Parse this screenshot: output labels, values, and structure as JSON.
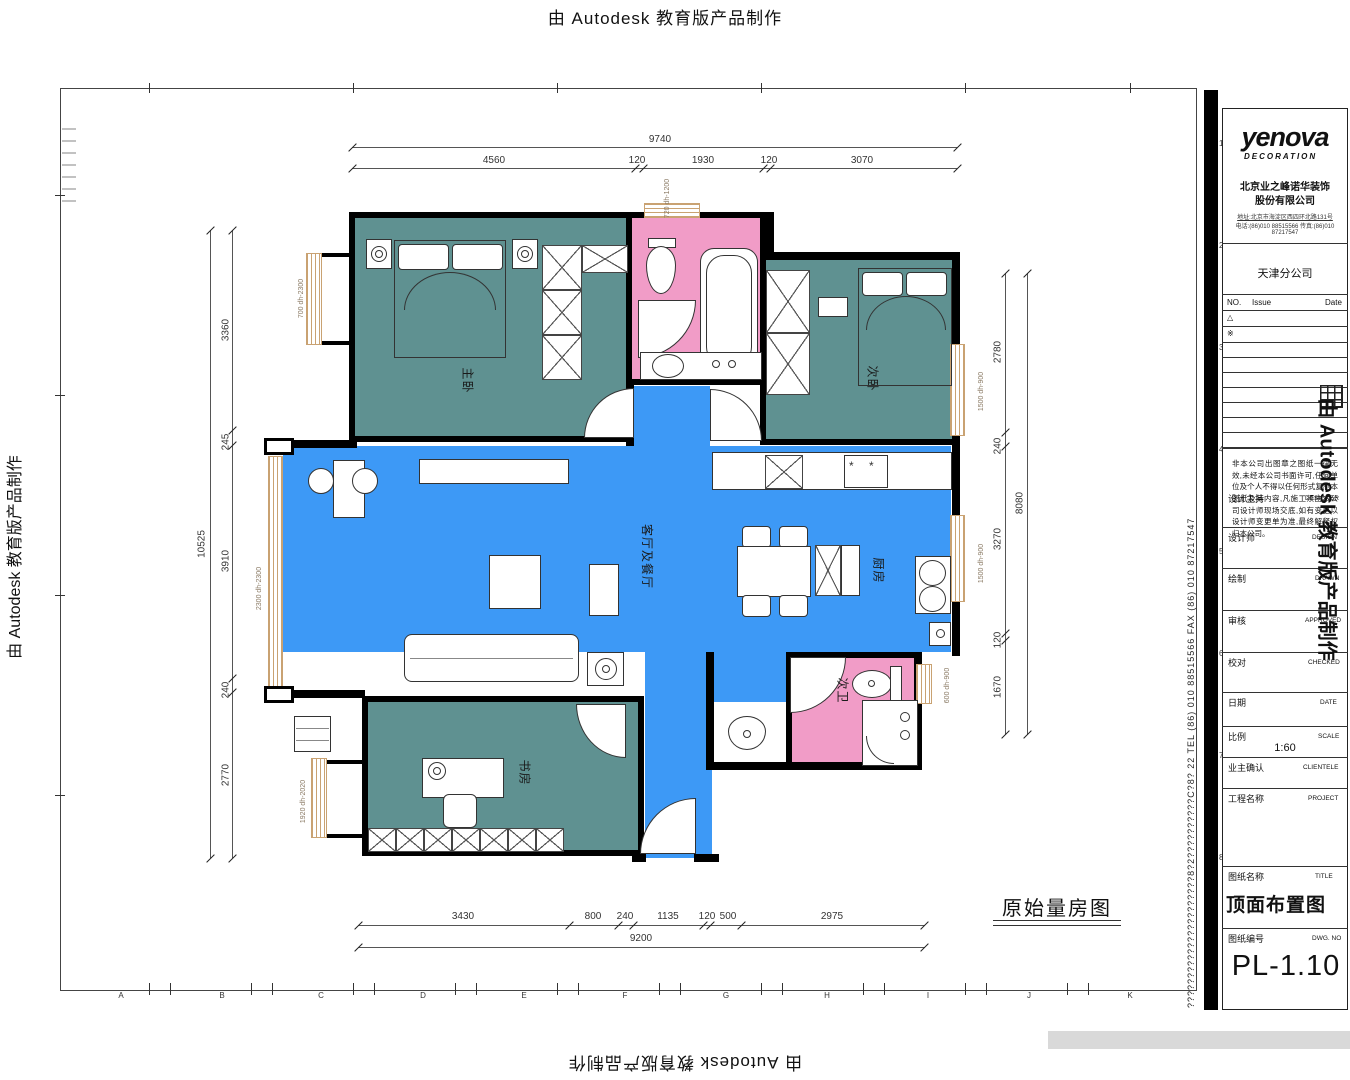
{
  "watermark": {
    "text": "由 Autodesk 教育版产品制作"
  },
  "plan": {
    "caption": "原始量房图",
    "rooms": [
      "主卧",
      "次卧",
      "客厅及餐厅",
      "厨房",
      "次卫",
      "书房"
    ],
    "window_tags": [
      "700 dh-2300",
      "2300 dh-2300",
      "1920 dh-2020",
      "720 dh-1200",
      "1500 dh-900",
      "1500 dh-900",
      "600 dh-900"
    ]
  },
  "dimensions": {
    "top": {
      "overall": "9740",
      "segments": [
        "4560",
        "120",
        "1930",
        "120",
        "3070"
      ]
    },
    "bottom": {
      "overall": "9200",
      "segments": [
        "3430",
        "800",
        "240",
        "1135",
        "120",
        "500",
        "2975"
      ]
    },
    "left": {
      "overall": "10525",
      "segments": [
        "3360",
        "245",
        "3910",
        "240",
        "2770"
      ]
    },
    "right": {
      "overall": "8080",
      "segments": [
        "2780",
        "240",
        "3270",
        "120",
        "1670"
      ]
    }
  },
  "sheet": {
    "zone_letters": [
      "A",
      "B",
      "C",
      "D",
      "E",
      "F",
      "G",
      "H",
      "I",
      "J",
      "K"
    ],
    "zone_numbers": [
      "1",
      "2",
      "3",
      "4",
      "5",
      "6",
      "7",
      "8"
    ],
    "side_contact": "??????????????????????8?2??????????C?8?  22  TEL (86) 010 88515566  FAX (86) 010 87217547"
  },
  "title_block": {
    "logo_main": "yenova",
    "logo_sub": "DECORATION",
    "company_line1": "北京业之峰诺华装饰",
    "company_line2": "股份有限公司",
    "company_info1": "地址:北京市海淀区西四环北路131号",
    "company_info2": "电话:(86)010 88515566 传真:(86)010 87217547",
    "branch": "天津分公司",
    "rev_no": "NO.",
    "rev_issue": "Issue",
    "rev_date": "Date",
    "rev_rows": [
      "△",
      "※"
    ],
    "disclaimer": "非本公司出图章之图纸一律无效,未经本公司书面许可,任何单位及个人不得以任何形式复制本图纸及其内容,凡施工须由本公司设计师现场交底,如有变更以设计师变更单为准,最终解释权归本公司。",
    "fields": [
      {
        "cn": "设计主持",
        "en": "DESIGNER"
      },
      {
        "cn": "设计师",
        "en": "DESIGN"
      },
      {
        "cn": "绘制",
        "en": "DRAWN"
      },
      {
        "cn": "审核",
        "en": "APPROVED"
      },
      {
        "cn": "校对",
        "en": "CHECKED"
      },
      {
        "cn": "日期",
        "en": "DATE"
      },
      {
        "cn": "比例",
        "en": "SCALE"
      },
      {
        "cn": "业主确认",
        "en": "CLIENTELE"
      },
      {
        "cn": "工程名称",
        "en": "PROJECT"
      },
      {
        "cn": "图纸名称",
        "en": "TITLE"
      },
      {
        "cn": "图纸编号",
        "en": "DWG. NO"
      }
    ],
    "scale_value": "1:60",
    "drawing_title": "顶面布置图",
    "drawing_no": "PL-1.10"
  },
  "colors": {
    "blue": "#3D99F6",
    "teal": "#5F9191",
    "pink": "#F19CC7",
    "tan": "#C9A272"
  }
}
